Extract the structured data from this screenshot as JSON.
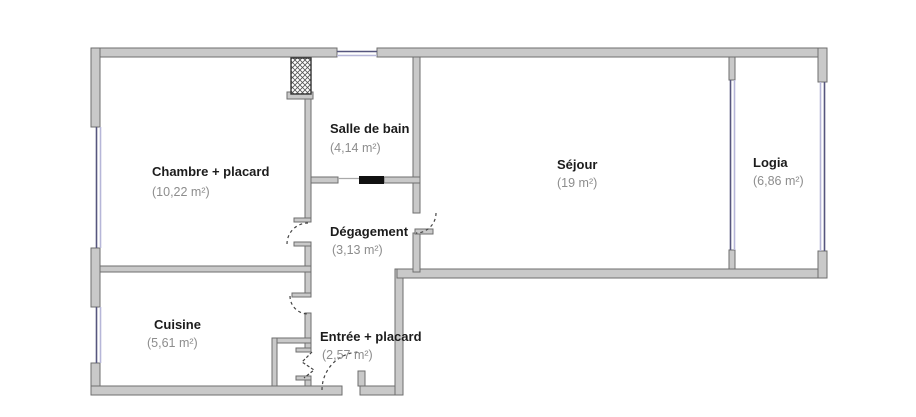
{
  "diagram": {
    "type": "floor-plan",
    "rooms": [
      {
        "name": "Chambre + placard",
        "area": "(10,22 m²)"
      },
      {
        "name": "Salle de bain",
        "area": "(4,14 m²)"
      },
      {
        "name": "Dégagement",
        "area": "(3,13 m²)"
      },
      {
        "name": "Séjour",
        "area": "(19 m²)"
      },
      {
        "name": "Logia",
        "area": "(6,86 m²)"
      },
      {
        "name": "Cuisine",
        "area": "(5,61 m²)"
      },
      {
        "name": "Entrée + placard",
        "area": "(2,57 m²)"
      }
    ],
    "colors": {
      "background": "#ffffff",
      "wall_fill": "#c9c9c9",
      "wall_stroke": "#6e6e6e",
      "window_dark": "#56567e",
      "window_light": "#b6b6d8",
      "room_name_text": "#1c1c1c",
      "room_area_text": "#8d8d8d",
      "sliding_door": "#111111",
      "shaft_border": "#333333"
    }
  }
}
